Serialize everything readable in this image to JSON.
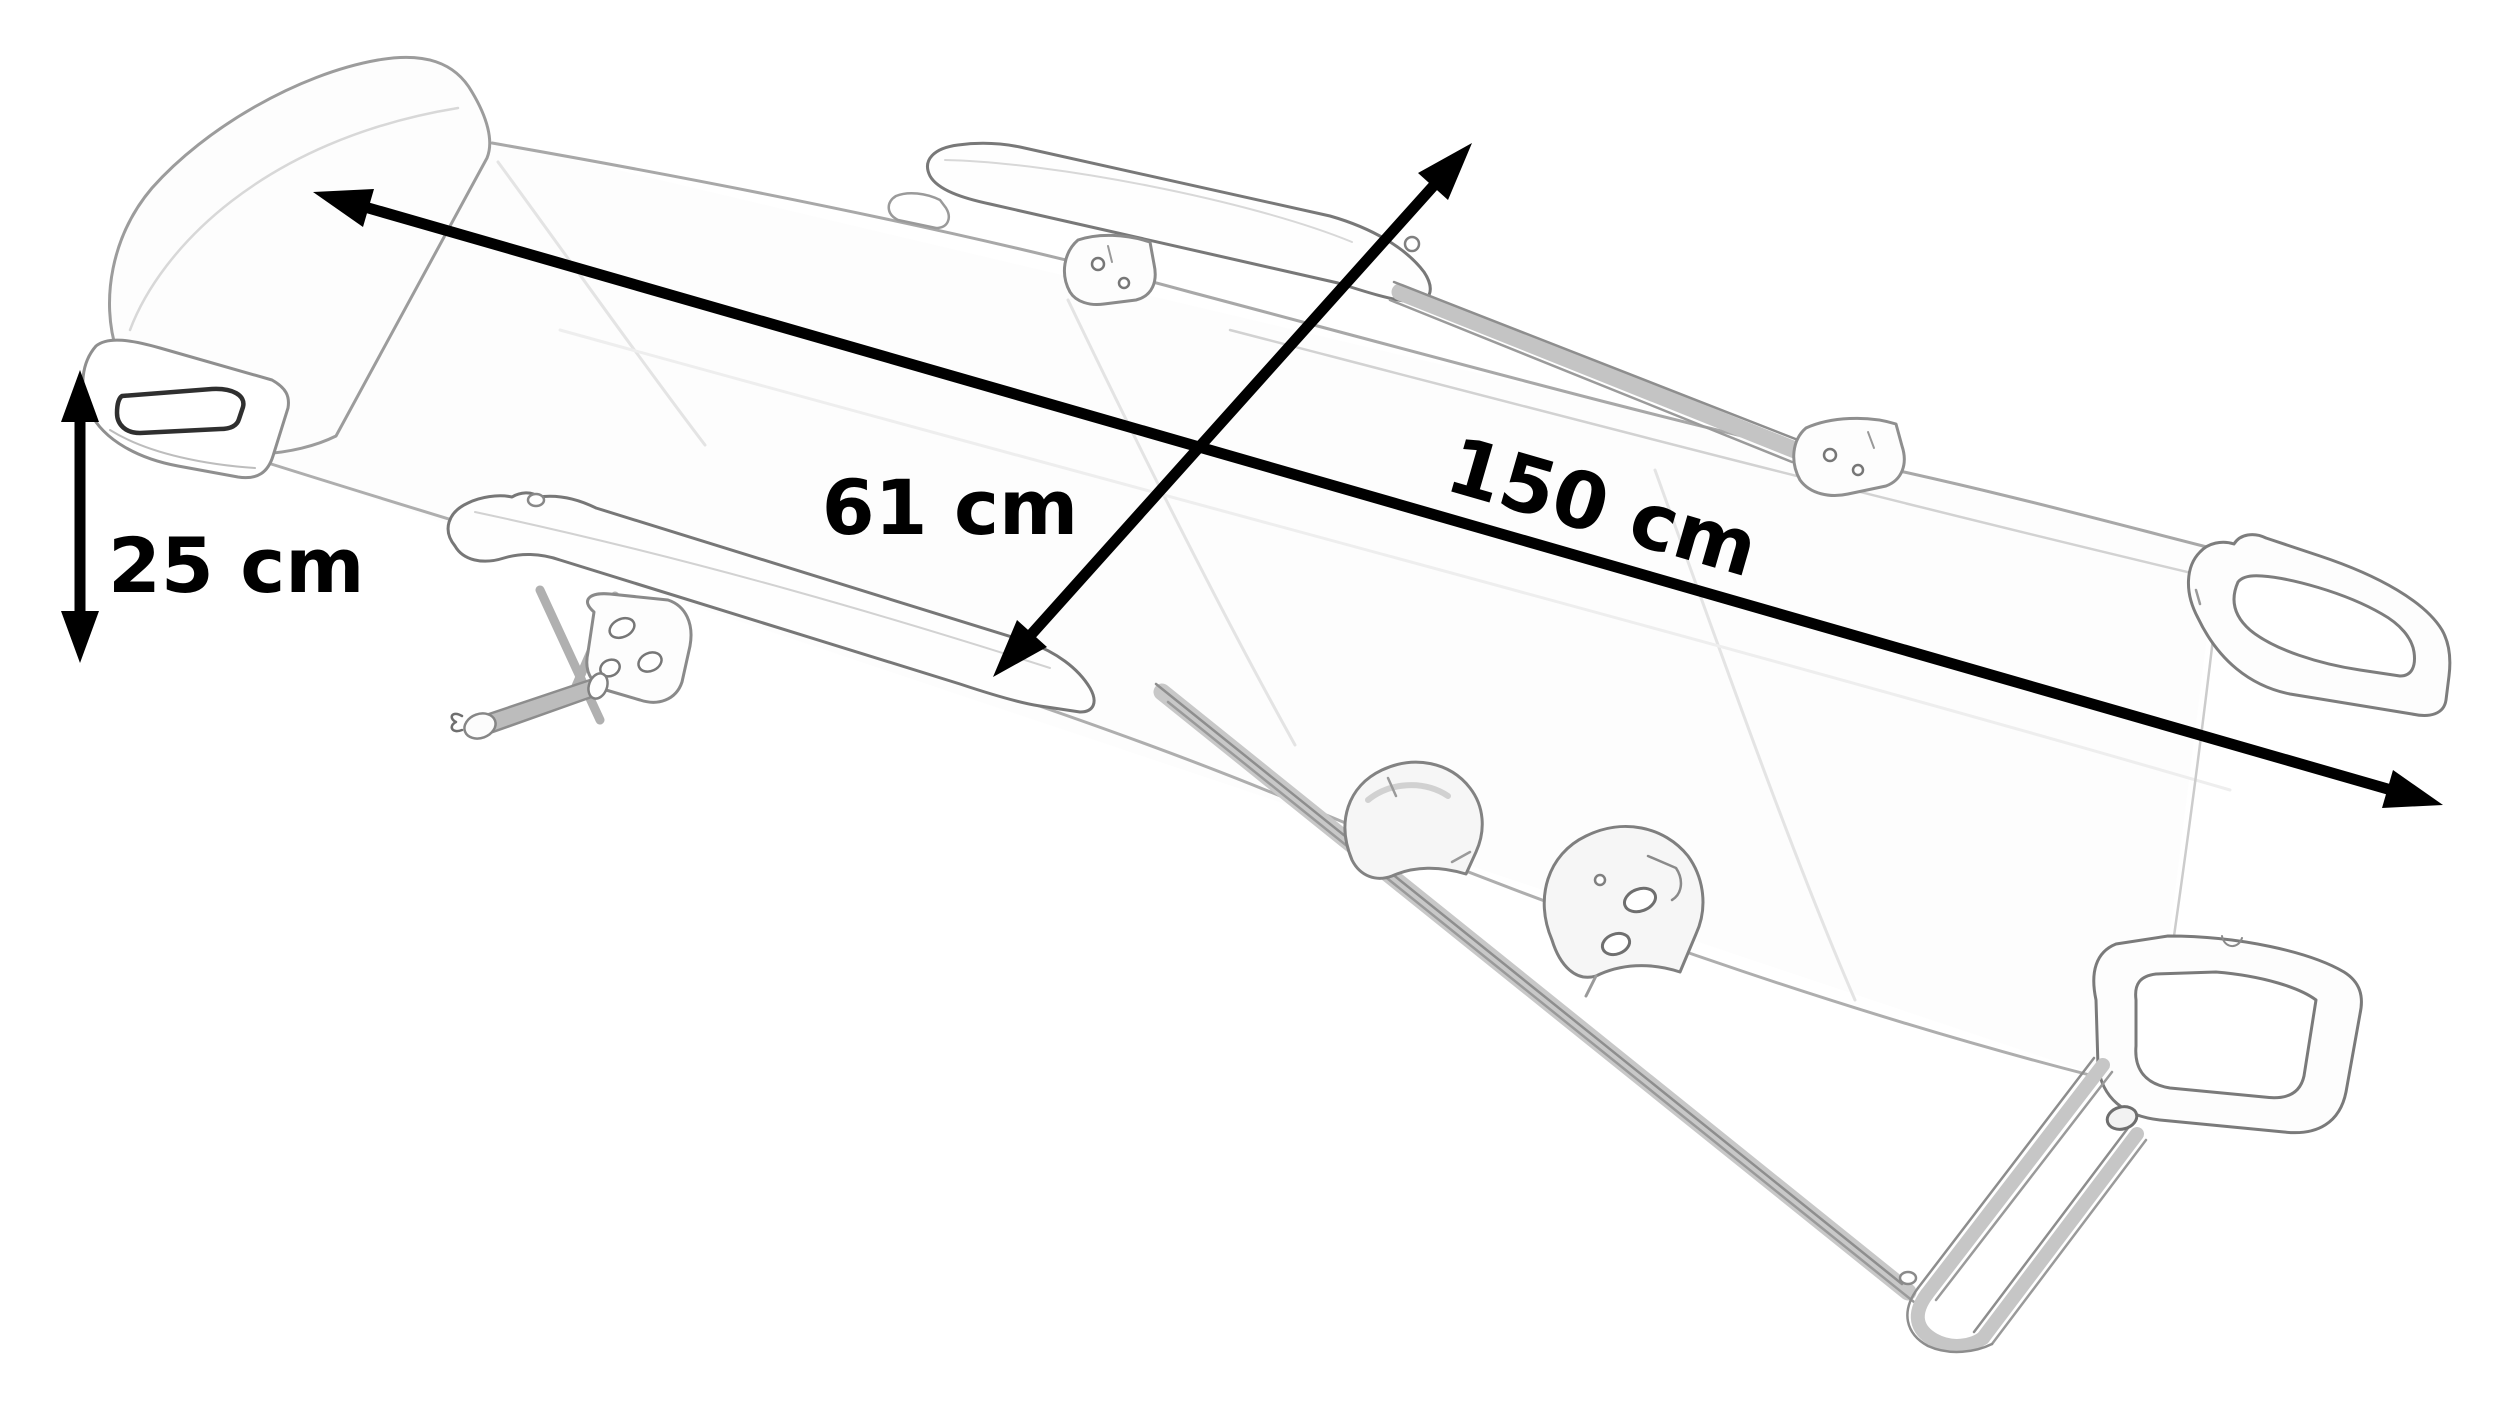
{
  "diagram": {
    "subject": "folding-camping-lounger-outline-sketch",
    "dimension_labels": {
      "length": "150 cm",
      "width": "61 cm",
      "height": "25 cm"
    },
    "dimension_values": {
      "length_cm": 150,
      "width_cm": 61,
      "height_cm": 25
    },
    "colors": {
      "background": "#ffffff",
      "arrows_and_text": "#000000",
      "sketch_stroke": "#8f8f8f",
      "sketch_faint": "#d9d9d9"
    }
  }
}
